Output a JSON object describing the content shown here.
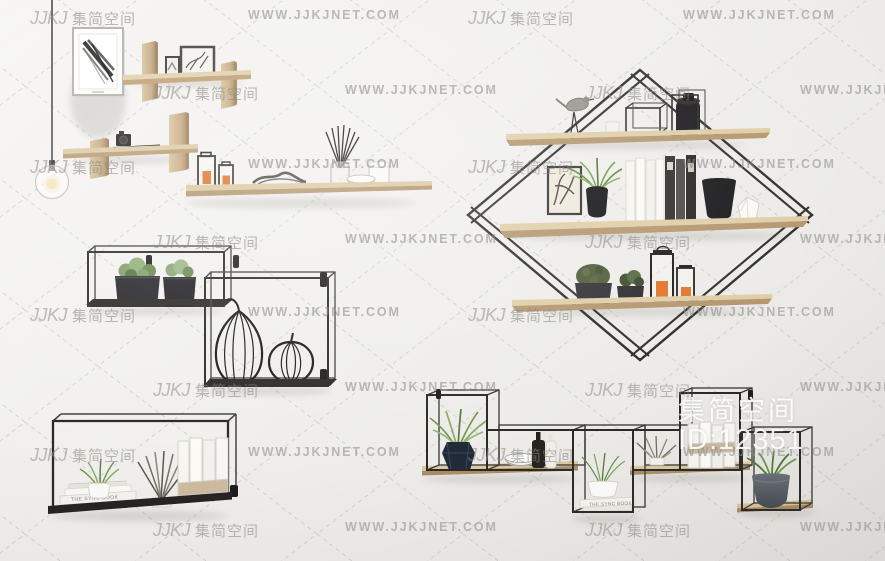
{
  "meta": {
    "width": 885,
    "height": 561
  },
  "watermarks": {
    "site_text": "WWW.JJKJNET.COM",
    "logo_text": "JJKJ",
    "brand_text": "集简空间",
    "row_ys": [
      8,
      83,
      157,
      232,
      305,
      380,
      445,
      520
    ],
    "row_x_offsets": [
      [
        30,
        248,
        468,
        683
      ],
      [
        153,
        345,
        585,
        800
      ]
    ],
    "pattern": [
      "brand",
      "site",
      "brand",
      "site"
    ]
  },
  "overlay_label": {
    "brand": "集简空间",
    "id_text": "ID:12351"
  },
  "texts": {
    "sync_book_spine": "THE SYNC BOOK"
  },
  "palette": {
    "wall": "#f0efed",
    "wood_top": "#dcc9a3",
    "wood_front": "#b3966e",
    "metal_frame": "#2d2b29",
    "plant_green": "#6f9a4a",
    "candle_orange": "#e0762c",
    "navy_vase": "#202a38",
    "gray_pot": "#596066",
    "watermark_gray": "#95948f",
    "label_white": "#ffffff"
  },
  "scene_objects": [
    "pendant-lamp",
    "framed-artwork",
    "cross-plank-shelf-top",
    "cross-plank-shelf-mid",
    "long-wood-shelf",
    "wire-cube-shelf-planters",
    "wire-cube-shelf-fruit",
    "diamond-wire-shelf",
    "metal-box-shelf-books",
    "modular-metal-shelf"
  ]
}
